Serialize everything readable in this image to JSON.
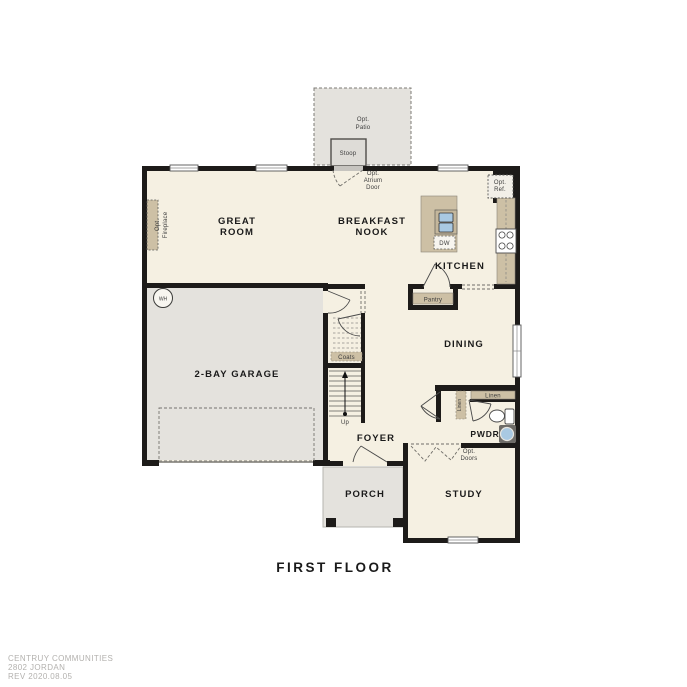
{
  "title": "FIRST FLOOR",
  "footer": [
    "CENTRUY COMMUNITIES",
    "2802 JORDAN",
    "REV 2020.08.05"
  ],
  "rooms": {
    "great_room": [
      "GREAT",
      "ROOM"
    ],
    "breakfast_nook": [
      "BREAKFAST",
      "NOOK"
    ],
    "kitchen": "KITCHEN",
    "dining": "DINING",
    "garage": "2-BAY GARAGE",
    "foyer": "FOYER",
    "porch": "PORCH",
    "study": "STUDY",
    "powder": "PWDR"
  },
  "fixtures": {
    "opt_patio": [
      "Opt.",
      "Patio"
    ],
    "stoop": "Stoop",
    "atrium_door": [
      "Opt.",
      "Atrium",
      "Door"
    ],
    "opt_ref": [
      "Opt.",
      "Ref."
    ],
    "fireplace": [
      "Opt.",
      "Fireplace"
    ],
    "water_heater": "WH",
    "dishwasher": "DW",
    "pantry": "Pantry",
    "coats": "Coats",
    "stairs_up": "Up",
    "linen_hall": "Linen",
    "linen_closet": "Linen",
    "opt_doors": [
      "Opt.",
      "Doors"
    ]
  },
  "colors": {
    "floor": "#f5f0e2",
    "concrete": "#e4e2dd",
    "wall": "#1d1b19",
    "cabinet": "#cdc0a5",
    "sink_blue": "#a9c9e2",
    "footer_text": "#b3b1ae"
  }
}
